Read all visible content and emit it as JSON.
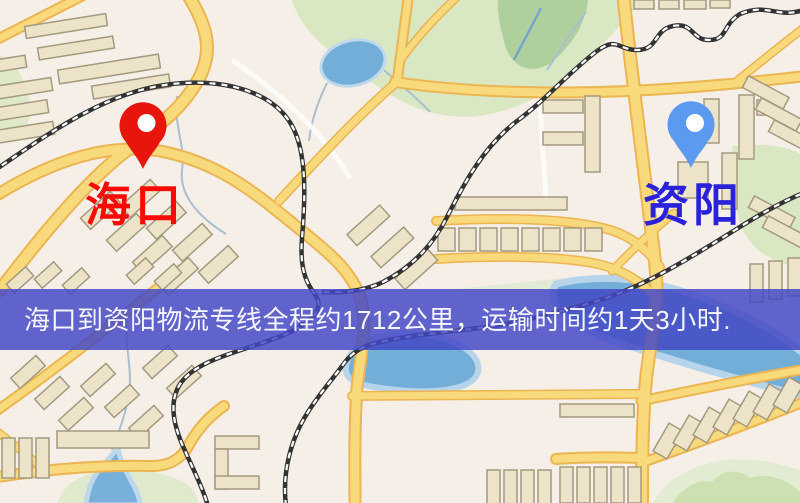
{
  "banner": {
    "text": "海口到资阳物流专线全程约1712公里，运输时间约1天3小时.",
    "bg_color": "#4347c5",
    "text_color": "#f6f6ff"
  },
  "markers": {
    "origin": {
      "label": "海口",
      "pin_color": "#e8150d",
      "label_color": "#fa0a05"
    },
    "destination": {
      "label": "资阳",
      "pin_color": "#5b9af0",
      "label_color": "#2a22db"
    }
  },
  "palette": {
    "background": "#f5efe8",
    "park": "#d9e7c2",
    "water": "#72aed8",
    "water_shore": "#b7d4ea",
    "road": "#f8d97c",
    "road_casing": "#ebb551",
    "building": "#ede3c8",
    "building_outline": "#a39a80",
    "railway": "#333333",
    "railway_dash": "#ffffff"
  }
}
